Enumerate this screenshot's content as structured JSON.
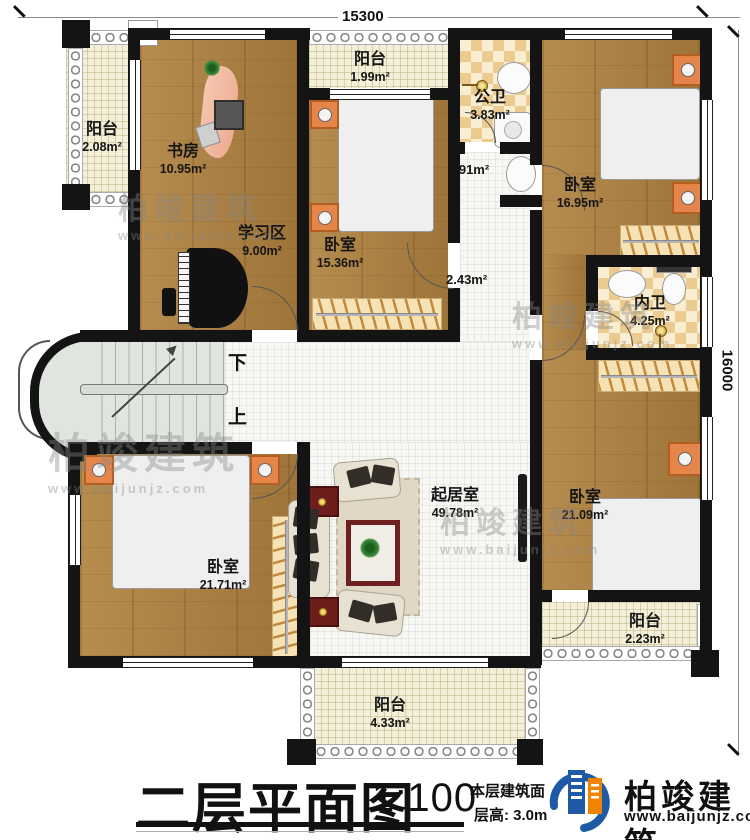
{
  "dimensions": {
    "top": "15300",
    "right": "16000"
  },
  "rooms": {
    "balcony_left": {
      "name": "阳台",
      "area": "2.08m²"
    },
    "study": {
      "name": "书房",
      "area": "10.95m²"
    },
    "study_area": {
      "name": "学习区",
      "area": "9.00m²"
    },
    "balcony_top": {
      "name": "阳台",
      "area": "1.99m²"
    },
    "bedroom_mid": {
      "name": "卧室",
      "area": "15.36m²"
    },
    "bath_public": {
      "name": "公卫",
      "area": "3.83m²"
    },
    "wash_niche": {
      "area": "0.91m²"
    },
    "hallway": {
      "area": "2.43m²"
    },
    "bedroom_top_right": {
      "name": "卧室",
      "area": "16.95m²"
    },
    "bath_inner": {
      "name": "内卫",
      "area": "4.25m²"
    },
    "bedroom_bottom_right": {
      "name": "卧室",
      "area": "21.09m²"
    },
    "balcony_right": {
      "name": "阳台",
      "area": "2.23m²"
    },
    "living": {
      "name": "起居室",
      "area": "49.78m²"
    },
    "bedroom_bottom_left": {
      "name": "卧室",
      "area": "21.71m²"
    },
    "balcony_bottom": {
      "name": "阳台",
      "area": "4.33m²"
    }
  },
  "stairs": {
    "down": "下",
    "up": "上"
  },
  "titleblock": {
    "title": "二层平面图",
    "scale": "1:100",
    "area_text": "本层建筑面",
    "floor_height": "层高: 3.0m"
  },
  "brand": {
    "name": "柏竣建筑",
    "site": "www.baijunjz.com"
  },
  "colors": {
    "wall": "#141414",
    "wood": "#a97e40",
    "bath_tile": "#eccb90",
    "balcony_tile": "#f3efd8",
    "bed_blue": "#5cc3dd",
    "furniture_orange": "#e5854a",
    "logo_blue": "#1e5aa6",
    "logo_orange": "#f08300"
  }
}
